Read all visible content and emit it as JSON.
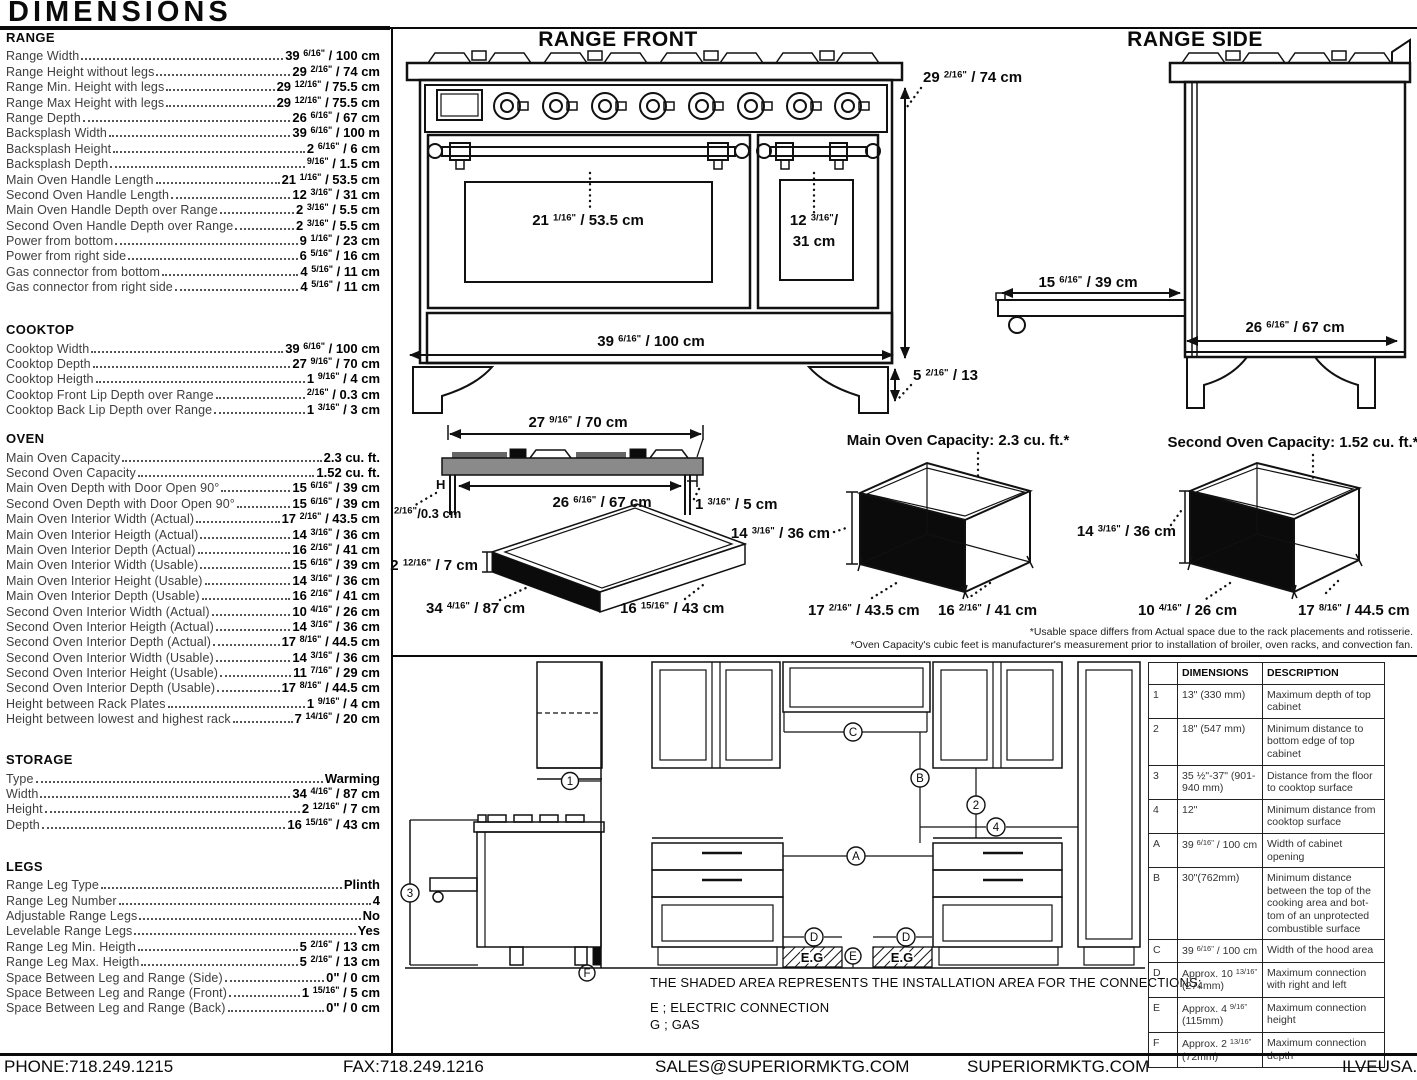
{
  "title": "DIMENSIONS",
  "specs": [
    {
      "name": "RANGE",
      "rows": [
        {
          "l": "Range Width",
          "v": "39 6/16\" / 100 cm"
        },
        {
          "l": "Range Height without legs",
          "v": "29 2/16\" / 74 cm"
        },
        {
          "l": "Range Min. Height with legs",
          "v": "29 12/16\" / 75.5 cm"
        },
        {
          "l": "Range Max Height with legs",
          "v": "29 12/16\" / 75.5 cm"
        },
        {
          "l": "Range Depth",
          "v": "26 6/16\" / 67 cm"
        },
        {
          "l": "Backsplash Width",
          "v": "39 6/16\" / 100 m"
        },
        {
          "l": "Backsplash Height",
          "v": "2 6/16\" / 6 cm"
        },
        {
          "l": "Backsplash Depth",
          "v": "9/16\" / 1.5 cm"
        },
        {
          "l": "Main Oven Handle Length",
          "v": "21 1/16\" / 53.5 cm"
        },
        {
          "l": "Second Oven Handle Length",
          "v": "12 3/16\" / 31 cm"
        },
        {
          "l": "Main Oven Handle Depth over Range",
          "v": "2 3/16\" / 5.5 cm"
        },
        {
          "l": "Second Oven Handle Depth over Range",
          "v": "2 3/16\" / 5.5 cm"
        },
        {
          "l": "Power from bottom",
          "v": "9 1/16\" / 23 cm"
        },
        {
          "l": "Power from right side",
          "v": "6 5/16\" / 16 cm"
        },
        {
          "l": "Gas connector from bottom",
          "v": "4 5/16\" / 11 cm"
        },
        {
          "l": "Gas connector from right side",
          "v": "4 5/16\" / 11 cm"
        }
      ]
    },
    {
      "name": "COOKTOP",
      "rows": [
        {
          "l": "Cooktop Width",
          "v": "39 6/16\" / 100 cm"
        },
        {
          "l": "Cooktop Depth",
          "v": "27 9/16\" / 70 cm"
        },
        {
          "l": "Cooktop Heigth",
          "v": "1 9/16\" / 4 cm"
        },
        {
          "l": "Cooktop Front Lip Depth over Range",
          "v": "2/16\" / 0.3 cm"
        },
        {
          "l": "Cooktop Back Lip Depth over Range",
          "v": "1 3/16\" / 3 cm"
        }
      ]
    },
    {
      "name": "OVEN",
      "rows": [
        {
          "l": "Main Oven Capacity",
          "v": "2.3 cu. ft."
        },
        {
          "l": "Second Oven Capacity",
          "v": "1.52 cu. ft."
        },
        {
          "l": "Main Oven Depth with Door Open 90°",
          "v": "15 6/16\" / 39 cm"
        },
        {
          "l": "Second Oven Depth with Door Open 90°",
          "v": "15 6/16\" / 39 cm"
        },
        {
          "l": "Main Oven Interior Width (Actual)",
          "v": "17 2/16\" / 43.5 cm"
        },
        {
          "l": "Main Oven Interior Heigth (Actual)",
          "v": "14 3/16\" / 36 cm"
        },
        {
          "l": "Main Oven Interior Depth (Actual)",
          "v": "16 2/16\" / 41 cm"
        },
        {
          "l": "Main Oven Interior Width (Usable)",
          "v": "15 6/16\" / 39 cm"
        },
        {
          "l": "Main Oven Interior Height (Usable)",
          "v": "14 3/16\" / 36 cm"
        },
        {
          "l": "Main Oven Interior Depth (Usable)",
          "v": "16 2/16\" / 41 cm"
        },
        {
          "l": "Second Oven Interior Width (Actual)",
          "v": "10 4/16\" / 26 cm"
        },
        {
          "l": "Second Oven Interior Heigth (Actual)",
          "v": "14 3/16\" / 36 cm"
        },
        {
          "l": "Second Oven Interior Depth (Actual)",
          "v": "17 8/16\" / 44.5 cm"
        },
        {
          "l": "Second Oven Interior Width (Usable)",
          "v": "14 3/16\" / 36 cm"
        },
        {
          "l": "Second Oven Interior Height (Usable)",
          "v": "11 7/16\" / 29 cm"
        },
        {
          "l": "Second Oven Interior Depth (Usable)",
          "v": "17 8/16\" / 44.5 cm"
        },
        {
          "l": "Height between Rack Plates",
          "v": "1 9/16\" / 4 cm"
        },
        {
          "l": "Height between lowest and highest rack",
          "v": "7 14/16\" / 20 cm"
        }
      ]
    },
    {
      "name": "STORAGE",
      "rows": [
        {
          "l": "Type",
          "v": "Warming"
        },
        {
          "l": "Width",
          "v": "34 4/16\" / 87 cm"
        },
        {
          "l": "Height",
          "v": "2 12/16\" / 7 cm"
        },
        {
          "l": "Depth",
          "v": "16 15/16\" / 43 cm"
        }
      ]
    },
    {
      "name": "LEGS",
      "rows": [
        {
          "l": "Range Leg Type",
          "v": "Plinth"
        },
        {
          "l": "Range Leg Number",
          "v": "4"
        },
        {
          "l": "Adjustable Range Legs",
          "v": "No"
        },
        {
          "l": "Levelable Range Legs",
          "v": "Yes"
        },
        {
          "l": "Range Leg Min. Heigth",
          "v": "5 2/16\" / 13 cm"
        },
        {
          "l": "Range Leg Max. Heigth",
          "v": "5 2/16\" / 13 cm"
        },
        {
          "l": "Space Between Leg and Range (Side)",
          "v": "0\" / 0 cm"
        },
        {
          "l": "Space Between Leg and Range (Front)",
          "v": "1 15/16\" / 5 cm"
        },
        {
          "l": "Space Between Leg and Range (Back)",
          "v": "0\" / 0 cm"
        }
      ]
    }
  ],
  "diagrams": {
    "range_front": {
      "title": "RANGE FRONT",
      "main_handle": "21 1/16\" / 53.5 cm",
      "second_handle_l1": "12 3/16\"/",
      "second_handle_l2": "31 cm",
      "width": "39 6/16\" / 100 cm",
      "height": "29 2/16\" / 74 cm",
      "leg_height": "5 2/16\" / 13"
    },
    "range_side": {
      "title": "RANGE SIDE",
      "door_depth": "15 6/16\" / 39 cm",
      "depth": "26 6/16\" / 67 cm"
    },
    "cooktop_profile": {
      "width": "27 9/16\" / 70 cm",
      "inner_width": "26 6/16\" / 67 cm",
      "h_label": "H",
      "front_lip": "2/16\"/0.3 cm",
      "back_lip": "1 3/16\" / 5 cm"
    },
    "storage_drawer": {
      "height": "2 12/16\" / 7 cm",
      "width": "34 4/16\" / 87 cm",
      "depth": "16 15/16\" / 43 cm"
    },
    "main_oven": {
      "title": "Main Oven Capacity: 2.3 cu. ft.*",
      "height": "14 3/16\" / 36 cm",
      "width": "17 2/16\" / 43.5 cm",
      "depth": "16 2/16\" / 41 cm"
    },
    "second_oven": {
      "title": "Second Oven Capacity: 1.52 cu. ft.*",
      "height": "14 3/16\" / 36 cm",
      "width": "10 4/16\" / 26 cm",
      "depth": "17 8/16\" / 44.5 cm"
    },
    "footnotes": [
      "*Usable space differs from Actual space due to the rack placements and rotisserie.",
      "*Oven Capacity's cubic feet is manufacturer's measurement prior to installation of broiler, oven racks, and convection fan."
    ]
  },
  "installation": {
    "note": "THE SHADED AREA REPRESENTS THE INSTALLATION AREA FOR THE CONNECTIONS;",
    "legend_e": "E ; ELECTRIC CONNECTION",
    "legend_g": "G ; GAS",
    "shaded_label": "E.G",
    "markers": {
      "n1": "1",
      "n2": "2",
      "n3": "3",
      "n4": "4",
      "a": "A",
      "b": "B",
      "c": "C",
      "d": "D",
      "e": "E",
      "f": "F"
    },
    "table": {
      "headers": [
        "",
        "DIMENSIONS",
        "DESCRIPTION"
      ],
      "rows": [
        [
          "1",
          "13\" (330 mm)",
          "Maximum depth of top cabinet"
        ],
        [
          "2",
          "18\" (547 mm)",
          "Minimum distance to bottom edge of top cabinet"
        ],
        [
          "3",
          "35 ½\"-37\" (901-940 mm)",
          "Distance from the floor to cooktop surface"
        ],
        [
          "4",
          "12\"",
          "Minimum distance from cooktop surface"
        ],
        [
          "A",
          "39 6/16\" / 100 cm",
          "Width of cabinet opening"
        ],
        [
          "B",
          "30\"(762mm)",
          "Minimum distance between the top of the cooking area and bot- tom of an unprotected combustible surface"
        ],
        [
          "C",
          "39 6/16\" / 100 cm",
          "Width of the hood area"
        ],
        [
          "D",
          "Approx. 10 13/16\" (274mm)",
          "Maximum connection with right and left"
        ],
        [
          "E",
          "Approx. 4 9/16\" (115mm)",
          "Maximum connection height"
        ],
        [
          "F",
          "Approx. 2 13/16\" (72mm)",
          "Maximum connection depth"
        ]
      ]
    }
  },
  "footer": {
    "phone": "PHONE:718.249.1215",
    "fax": "FAX:718.249.1216",
    "email": "SALES@SUPERIORMKTG.COM",
    "site": "SUPERIORMKTG.COM",
    "brand": "ILVEUSA.COM"
  }
}
